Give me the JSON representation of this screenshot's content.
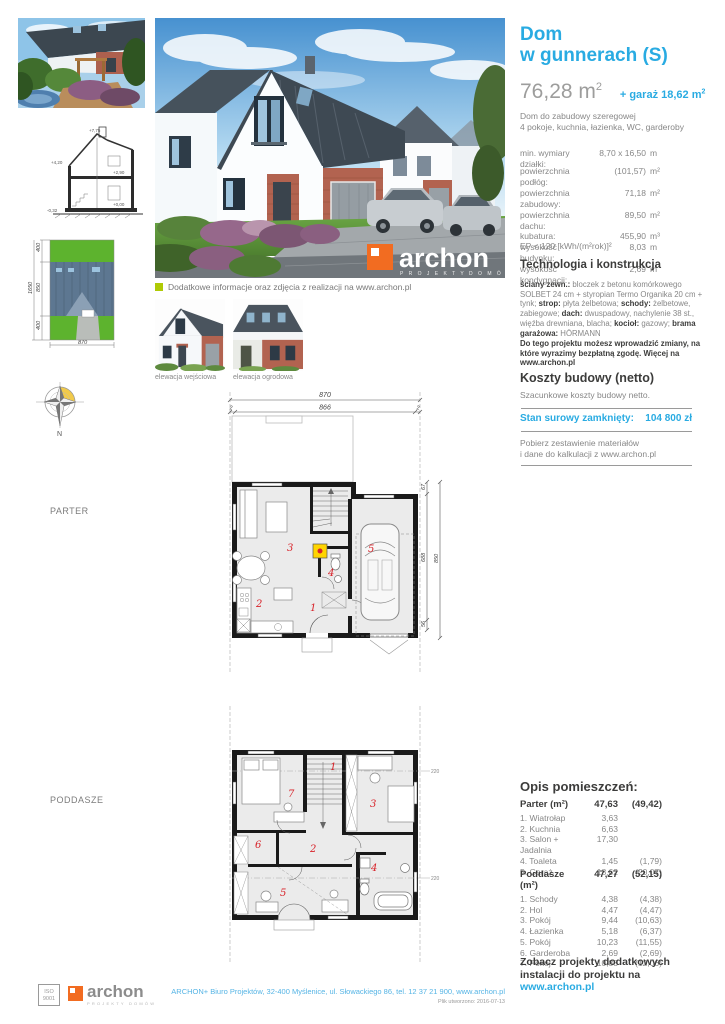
{
  "brand": {
    "blue": "#29abe2",
    "orange": "#f26c21",
    "lime": "#afca05",
    "red": "#d8232a"
  },
  "header": {
    "title_line1": "Dom",
    "title_line2": "w gunnerach (S)",
    "area_value": "76,28 m",
    "area_sup": "2",
    "garage_value": "+ garaż 18,62 m",
    "garage_sup": "2",
    "desc_line1": "Dom do zabudowy szeregowej",
    "desc_line2": "4 pokoje, kuchnia, łazienka, WC, garderoby"
  },
  "specs": {
    "plot_label": "min. wymiary działki:",
    "plot_value": "8,70 x 16,50",
    "plot_unit": "m",
    "rows": [
      {
        "label": "powierzchnia podłóg:",
        "value": "(101,57)",
        "unit": "m²"
      },
      {
        "label": "powierzchnia zabudowy:",
        "value": "71,18",
        "unit": "m²"
      },
      {
        "label": "powierzchnia dachu:",
        "value": "89,50",
        "unit": "m²"
      },
      {
        "label": "kubatura:",
        "value": "455,90",
        "unit": "m³"
      },
      {
        "label": "wysokość budynku:",
        "value": "8,03",
        "unit": "m"
      },
      {
        "label": "wysokość kondygnacji:",
        "value": "2,69",
        "unit": "m"
      }
    ],
    "ep": "EP < 120 [kWh/(m²rok)]²"
  },
  "technology": {
    "heading": "Technologia i konstrukcja",
    "seg": [
      {
        "b": "ściany zewn.:",
        "t": " bloczek z betonu komórkowego SOLBET 24 cm  + styropian Termo Organika 20 cm + tynk; "
      },
      {
        "b": "strop:",
        "t": " płyta żelbetowa; "
      },
      {
        "b": "schody:",
        "t": " żelbetowe, zabiegowe; "
      },
      {
        "b": "dach:",
        "t": " dwuspadowy, nachylenie 38 st., więźba drewniana, blacha; "
      },
      {
        "b": "kocioł:",
        "t": " gazowy; "
      },
      {
        "b": "brama garażowa:",
        "t": " HÖRMANN"
      }
    ],
    "note": "Do tego projektu możesz wprowadzić zmiany, na które wyrazimy bezpłatną zgodę. Więcej na www.archon.pl"
  },
  "costs": {
    "heading": "Koszty budowy (netto)",
    "subtitle": "Szacunkowe koszty budowy netto.",
    "state_label": "Stan surowy zamknięty:",
    "state_value": "104 800  zł",
    "download_line1": "Pobierz zestawienie materiałów",
    "download_line2": "i dane do kalkulacji z www.archon.pl"
  },
  "rooms": {
    "heading": "Opis pomieszczeń:",
    "parter": {
      "title": "Parter (m²)",
      "total": "47,63",
      "total_alt": "(49,42)",
      "items": [
        {
          "name": "1. Wiatrołap",
          "area": "3,63",
          "alt": ""
        },
        {
          "name": "2. Kuchnia",
          "area": "6,63",
          "alt": ""
        },
        {
          "name": "3. Salon + Jadalnia",
          "area": "17,30",
          "alt": ""
        },
        {
          "name": "4. Toaleta",
          "area": "1,45",
          "alt": "(1,79)"
        },
        {
          "name": "5. Garaż",
          "area": "18,62",
          "alt": "(20,07)"
        }
      ]
    },
    "poddasze": {
      "title": "Poddasze (m²)",
      "total": "47,27",
      "total_alt": "(52,15)",
      "items": [
        {
          "name": "1. Schody",
          "area": "4,38",
          "alt": "(4,38)"
        },
        {
          "name": "2. Hol",
          "area": "4,47",
          "alt": "(4,47)"
        },
        {
          "name": "3. Pokój",
          "area": "9,44",
          "alt": "(10,63)"
        },
        {
          "name": "4. Łazienka",
          "area": "5,18",
          "alt": "(6,37)"
        },
        {
          "name": "5. Pokój",
          "area": "10,23",
          "alt": "(11,55)"
        },
        {
          "name": "6. Garderoba",
          "area": "2,69",
          "alt": "(2,69)"
        },
        {
          "name": "7. Pokój",
          "area": "10,88",
          "alt": "(12,06)"
        }
      ]
    }
  },
  "extra": {
    "line1": "Zobacz projekty dodatkowych",
    "line2": "instalacji do projektu na",
    "link": "www.archon.pl"
  },
  "captions": {
    "info_line": "Dodatkowe informacje oraz zdjęcia z realizacji na www.archon.pl",
    "elevation1": "elewacja wejściowa",
    "elevation2": "elewacja ogrodowa",
    "parter_label": "PARTER",
    "poddasze_label": "PODDASZE",
    "compass_n": "N"
  },
  "plans": {
    "parter": {
      "top_total": "870",
      "top_inner": "866",
      "d2l": "2",
      "d2r": "2",
      "right_a": "67",
      "right_b": "688",
      "right_c": "56",
      "right_total": "850",
      "rooms": [
        "1",
        "2",
        "3",
        "4",
        "5"
      ]
    },
    "poddasze": {
      "rooms": [
        "1",
        "2",
        "3",
        "4",
        "5",
        "6",
        "7"
      ],
      "mark_top": "220",
      "mark_bottom": "220"
    },
    "siteplan": {
      "total": "1650",
      "seg_top": "400",
      "seg_mid": "850",
      "seg_bottom": "400",
      "width": "870"
    },
    "section": {
      "m1": "+7,75",
      "m2": "+4,20",
      "m3": "+2,90",
      "m4": "+0,00",
      "m5": "-0,32"
    }
  },
  "hero_logo": {
    "text": "archon",
    "sub": "P R O J E K T Y   D O M Ó W"
  },
  "footer": {
    "iso_line1": "ISO",
    "iso_line2": "9001",
    "logo_text": "archon",
    "logo_sub": "PROJEKTY DOMÓW",
    "address": "ARCHON+ Biuro Projektów,  32-400 Myślenice,  ul. Słowackiego 86,  tel. 12 37 21 900, www.archon.pl",
    "created": "Plik utworzono: 2016-07-13"
  }
}
